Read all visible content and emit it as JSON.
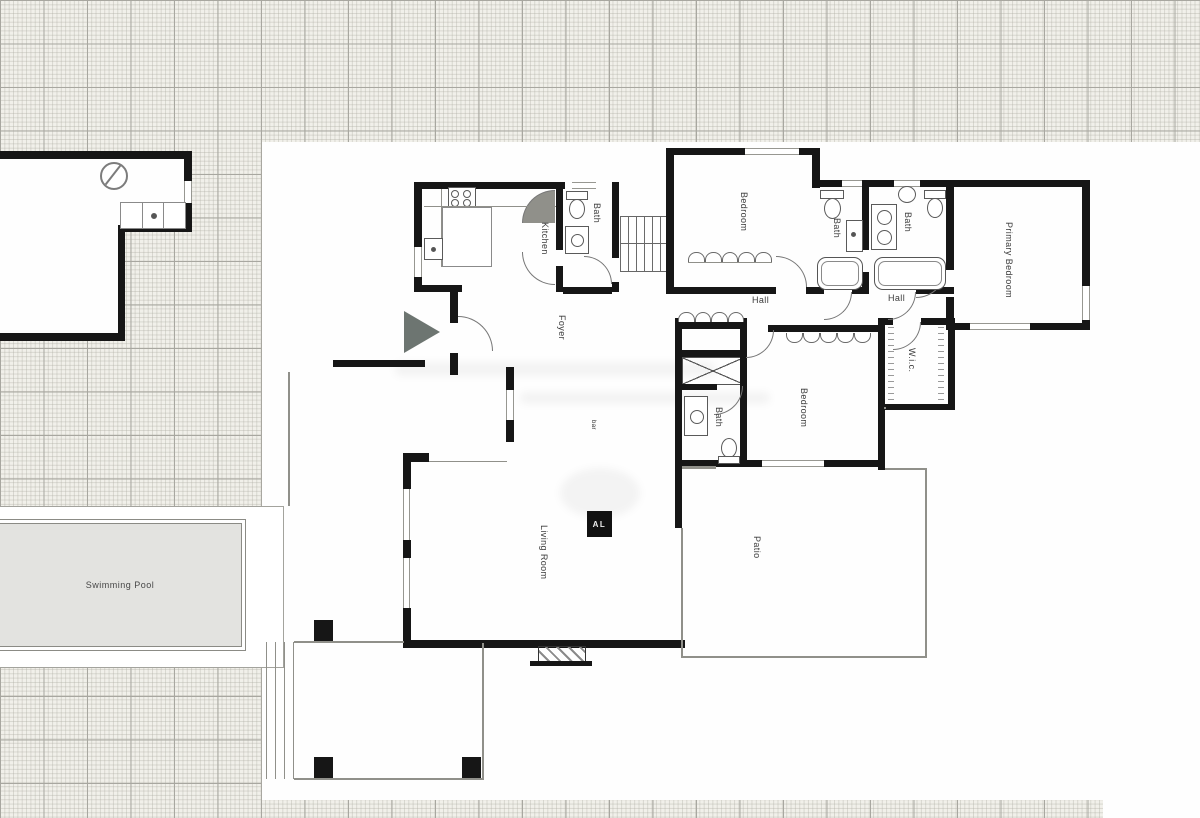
{
  "plan": {
    "rooms": {
      "kitchen": "Kitchen",
      "bath_top": "Bath",
      "bath_hall_a": "Bath",
      "bath_hall_b": "Bath",
      "bath_lower": "Bath",
      "bedroom_upper": "Bedroom",
      "bedroom_lower": "Bedroom",
      "primary_bedroom": "Primary Bedroom",
      "foyer": "Foyer",
      "hall_a": "Hall",
      "hall_b": "Hall",
      "wic": "W.i.c.",
      "living_room": "Living Room",
      "patio": "Patio",
      "bar": "bar"
    },
    "outdoor": {
      "swimming_pool": "Swimming Pool"
    },
    "logo": "AL"
  },
  "colors": {
    "wall": "#161616",
    "paper_grid_major": "#a8a7a0",
    "pool_fill": "#e3e3e0",
    "arrow": "#6d7571",
    "logo_bg": "#111111",
    "logo_text": "#ededed"
  }
}
